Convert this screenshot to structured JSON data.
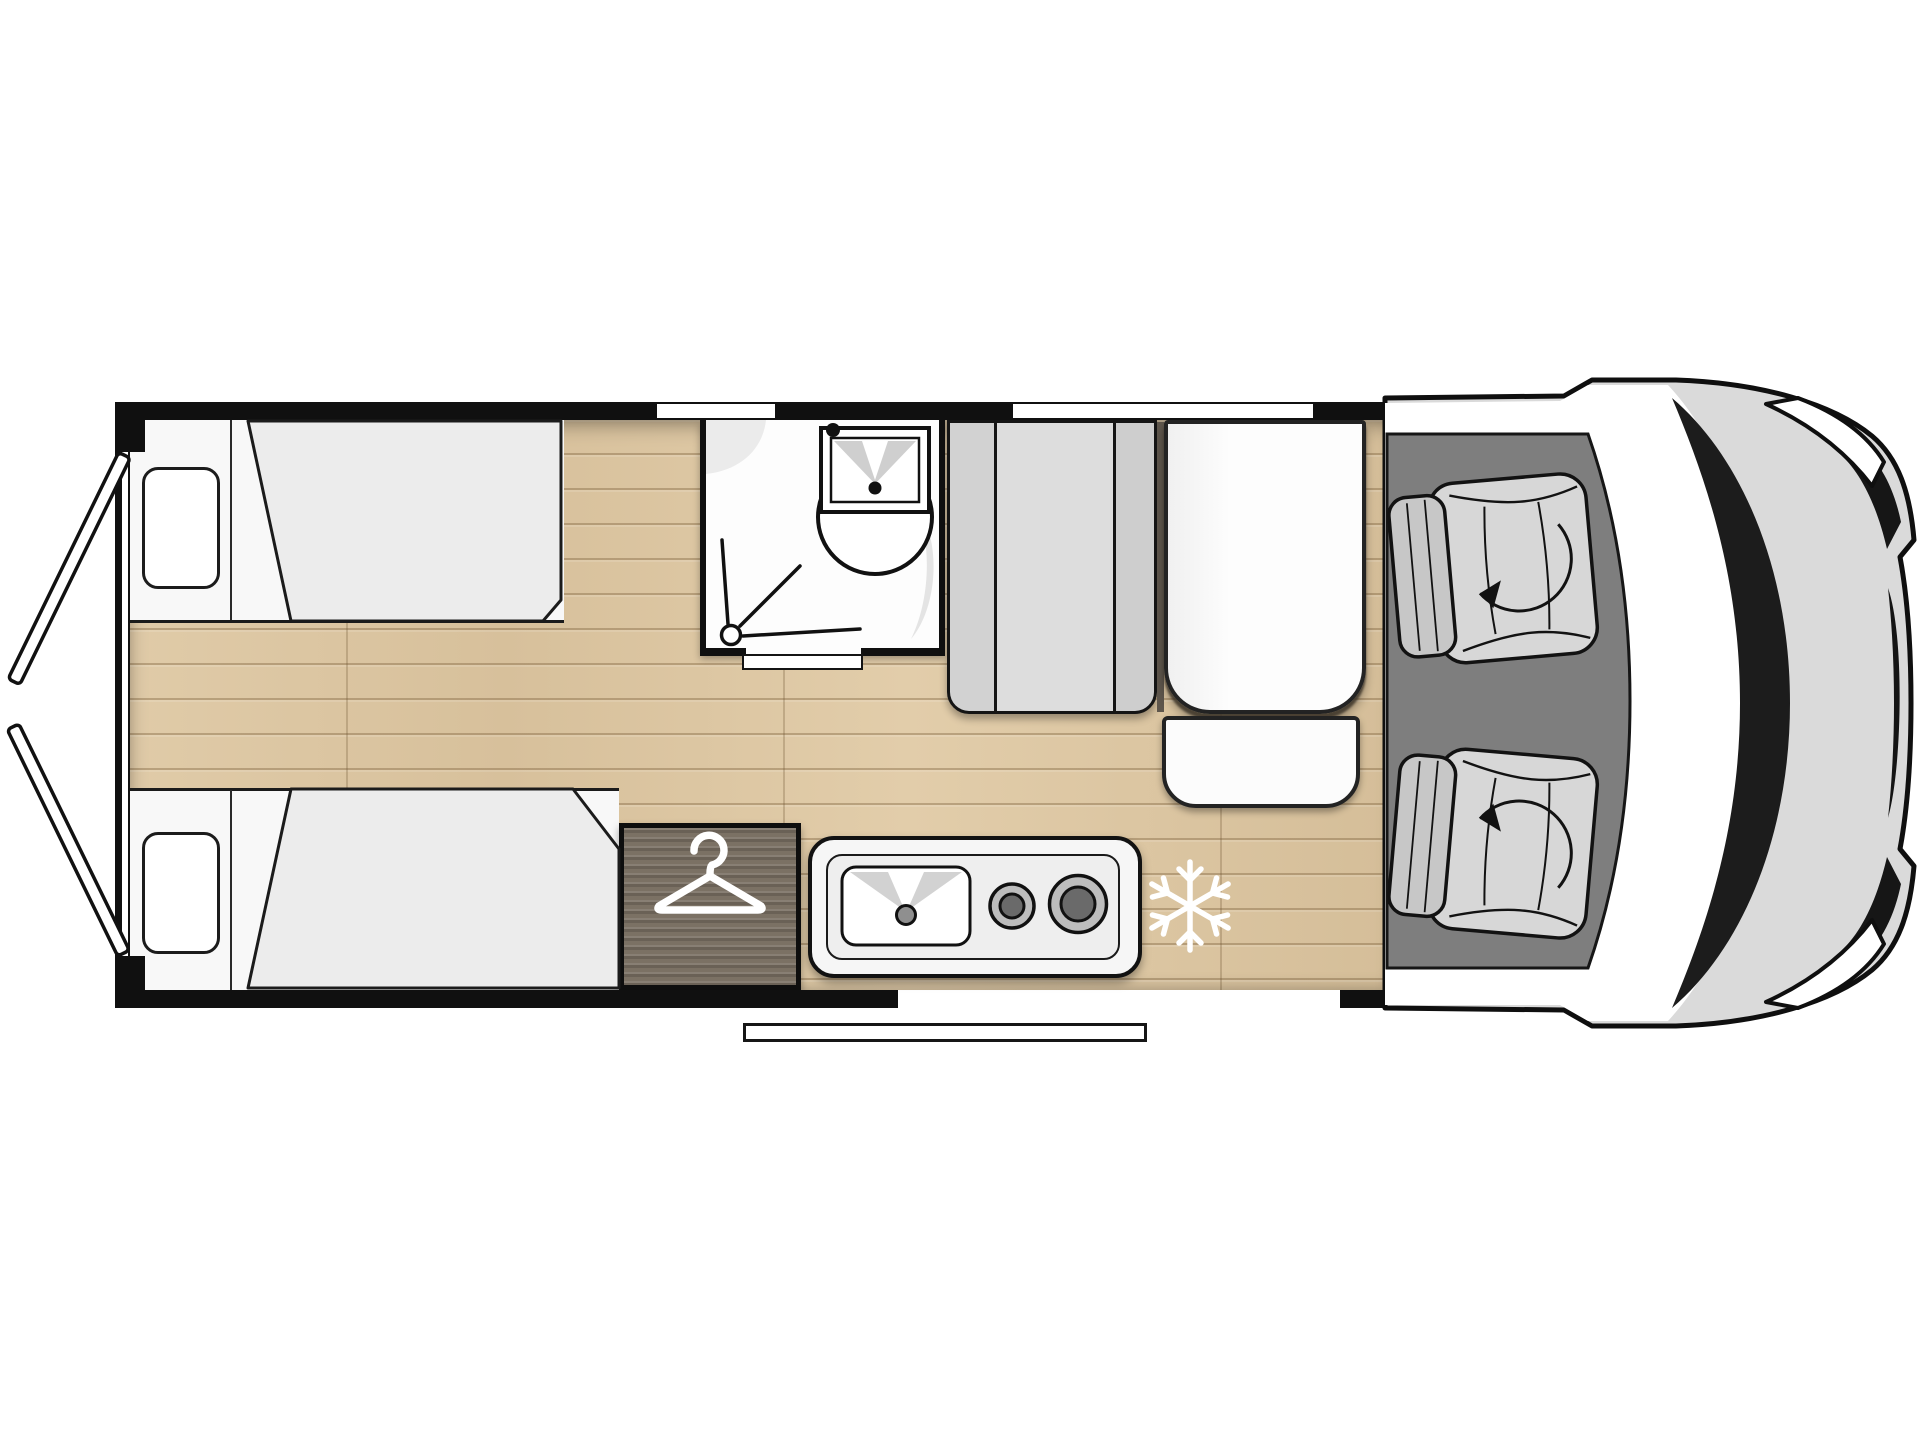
{
  "plan": {
    "type": "camper-van floor plan, top view",
    "orientation": "vehicle front on the right, rear doors open on the left"
  },
  "palette": {
    "wall": "#101010",
    "floor_wood": "#dcc6a2",
    "floor_seam": "#c3ab85",
    "furniture_white": "#f9f9f9",
    "mattress_gray": "#ececec",
    "cabinet_gray": "#d6d6d6",
    "wardrobe_wood": "#7b7164",
    "cab_floor_gray": "#7e7e7e",
    "vehicle_body_gray": "#dadada",
    "windshield_white": "#ffffff",
    "icon_white": "#ffffff",
    "outline_black": "#121212"
  },
  "areas": [
    "rear-door-top",
    "rear-door-bottom",
    "single-bed-top",
    "single-bed-bottom",
    "corridor-wood-floor",
    "shower-room",
    "washbasin",
    "shower-drain",
    "tall-cabinet",
    "dinette-bench",
    "dinette-table",
    "wardrobe",
    "kitchen-block",
    "fridge-position",
    "entry-step",
    "cab-floor",
    "swivel-seat-driver",
    "swivel-seat-passenger",
    "vehicle-front"
  ],
  "icons": [
    {
      "name": "hanger-icon",
      "meaning": "wardrobe / clothes storage"
    },
    {
      "name": "snowflake-icon",
      "meaning": "refrigerator position"
    },
    {
      "name": "shower-drain-icon",
      "meaning": "shower tray"
    },
    {
      "name": "basin-icon",
      "meaning": "washbasin with tap"
    },
    {
      "name": "sink-icon",
      "meaning": "kitchen sink with drain"
    },
    {
      "name": "burner-icon",
      "meaning": "two-ring gas hob"
    },
    {
      "name": "swivel-arrow-icon",
      "meaning": "cab seat rotates to living area"
    }
  ],
  "counts": {
    "beds": 2,
    "cab_seats": 2,
    "hob_burners": 2,
    "windows_top_wall": 2
  }
}
